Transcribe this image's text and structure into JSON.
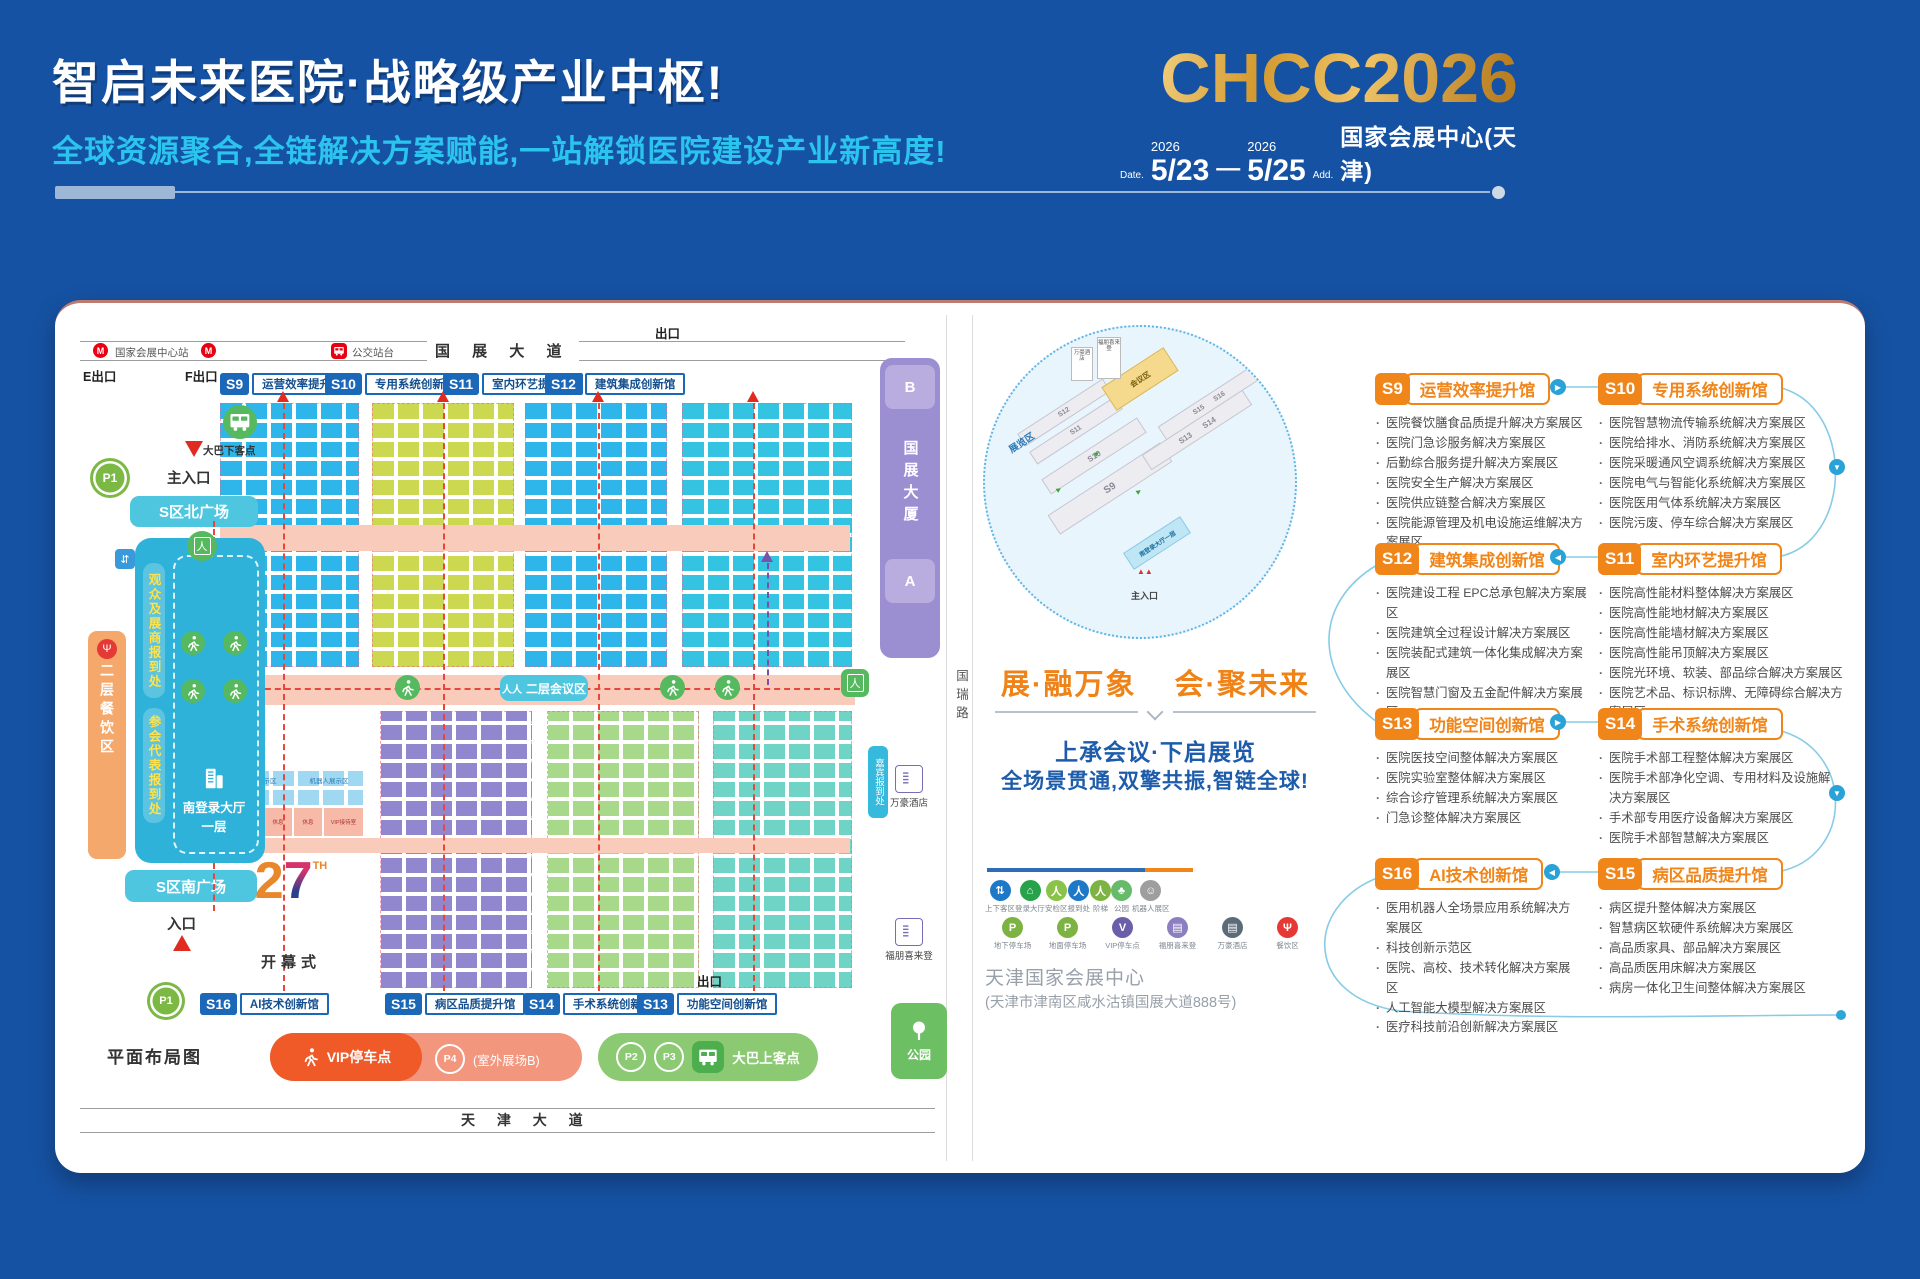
{
  "header": {
    "title": "智启未来医院·战略级产业中枢!",
    "subtitle": "全球资源聚合,全链解决方案赋能,一站解锁医院建设产业新高度!",
    "logo": "CHCC2026",
    "date_label": "Date.",
    "year_start": "2026",
    "date_start": "5/23",
    "date_dash": "—",
    "year_end": "2026",
    "date_end": "5/25",
    "addr_label": "Add.",
    "venue": "国家会展中心(天津)"
  },
  "map": {
    "caption": "平面布局图",
    "roads": {
      "top": "国 展 大 道",
      "bottom": "天 津 大 道",
      "right": "国瑞路"
    },
    "transit": {
      "station": "国家会展中心站",
      "bus_stop": "公交站台",
      "exit_e": "E出口",
      "exit_f": "F出口",
      "exit_top": "出口",
      "exit_bottom": "出口"
    },
    "halls_top": [
      {
        "id": "S9",
        "name": "运营效率提升馆"
      },
      {
        "id": "S10",
        "name": "专用系统创新馆"
      },
      {
        "id": "S11",
        "name": "室内环艺提升馆"
      },
      {
        "id": "S12",
        "name": "建筑集成创新馆"
      }
    ],
    "halls_bottom": [
      {
        "id": "S16",
        "name": "AI技术创新馆"
      },
      {
        "id": "S15",
        "name": "病区品质提升馆"
      },
      {
        "id": "S14",
        "name": "手术系统创新馆"
      },
      {
        "id": "S13",
        "name": "功能空间创新馆"
      }
    ],
    "west": {
      "main_entrance": "主入口",
      "bus_drop": "大巴下客点",
      "p1": "P1",
      "north_plaza": "S区北广场",
      "visitor_reg": "观众及展商报到处",
      "delegate_reg": "参会代表报到处",
      "dining": "二层餐饮区",
      "south_hall": "南登录大厅",
      "floor1": "一层",
      "south_plaza": "S区南广场",
      "entrance": "入口"
    },
    "center": {
      "meeting": "二层会议区",
      "ceremony": "开幕式",
      "logo_num2": "2",
      "logo_num7": "7",
      "logo_th": "TH",
      "robot_zone": "机器人展示区",
      "vip_room": "VIP接待室",
      "rest": "休息"
    },
    "east": {
      "b": "B",
      "tower": "国展大厦",
      "a": "A",
      "guest_reg": "嘉宾报到处",
      "hotel_marriott": "万豪酒店",
      "hotel_fourpoints": "福朋喜来登",
      "park": "公园"
    },
    "south": {
      "vip_parking": "VIP停车点",
      "p4": "P4",
      "outdoor": "(室外展场B)",
      "p2": "P2",
      "p3": "P3",
      "bus_pickup": "大巴上客点"
    }
  },
  "mini_map": {
    "zone_exhibition": "展览区",
    "zone_conference": "会议区",
    "s9": "S9",
    "s10": "S10",
    "s11": "S11",
    "s12": "S12",
    "s13": "S13",
    "s14": "S14",
    "s15": "S15",
    "s16": "S16",
    "south_hall": "南登录大厅一层",
    "main_entrance": "主入口",
    "hotel_marriott": "万豪酒店",
    "hotel_fourpoints": "福朋喜来登"
  },
  "slogan": {
    "left": "展·融万象",
    "right": "会·聚未来",
    "line1": "上承会议·下启展览",
    "line2": "全场景贯通,双擎共振,智链全球!"
  },
  "legend": {
    "row1": [
      {
        "label": "上下客区",
        "glyph": "⇅",
        "color": "#1e78c8"
      },
      {
        "label": "登录大厅",
        "glyph": "⌂",
        "color": "#27a24b"
      },
      {
        "label": "安检区",
        "glyph": "人",
        "color": "#8bc34a"
      },
      {
        "label": "报到处",
        "glyph": "人",
        "color": "#1e78c8"
      },
      {
        "label": "阶梯",
        "glyph": "人",
        "color": "#7cb342"
      },
      {
        "label": "公园",
        "glyph": "♣",
        "color": "#66bb6a"
      },
      {
        "label": "机器人展区",
        "glyph": "☺",
        "color": "#9e9e9e"
      }
    ],
    "row2": [
      {
        "label": "地下停车场",
        "glyph": "P",
        "color": "#7cb342"
      },
      {
        "label": "地面停车场",
        "glyph": "P",
        "color": "#7cb342"
      },
      {
        "label": "VIP停车点",
        "glyph": "V",
        "color": "#6a5fa8"
      },
      {
        "label": "福朋喜来登",
        "glyph": "▤",
        "color": "#8c7fc0"
      },
      {
        "label": "万豪酒店",
        "glyph": "▤",
        "color": "#5c6b7a"
      },
      {
        "label": "餐饮区",
        "glyph": "Ψ",
        "color": "#e53935"
      }
    ]
  },
  "address": {
    "name": "天津国家会展中心",
    "detail": "(天津市津南区咸水沽镇国展大道888号)"
  },
  "sections": [
    {
      "id": "S9",
      "name": "运营效率提升馆",
      "items": [
        "医院餐饮膳食品质提升解决方案展区",
        "医院门急诊服务解决方案展区",
        "后勤综合服务提升解决方案展区",
        "医院安全生产解决方案展区",
        "医院供应链整合解决方案展区",
        "医院能源管理及机电设施运维解决方案展区"
      ]
    },
    {
      "id": "S10",
      "name": "专用系统创新馆",
      "items": [
        "医院智慧物流传输系统解决方案展区",
        "医院给排水、消防系统解决方案展区",
        "医院采暖通风空调系统解决方案展区",
        "医院电气与智能化系统解决方案展区",
        "医院医用气体系统解决方案展区",
        "医院污废、停车综合解决方案展区"
      ]
    },
    {
      "id": "S12",
      "name": "建筑集成创新馆",
      "items": [
        "医院建设工程 EPC总承包解决方案展区",
        "医院建筑全过程设计解决方案展区",
        "医院装配式建筑一体化集成解决方案展区",
        "医院智慧门窗及五金配件解决方案展区"
      ]
    },
    {
      "id": "S11",
      "name": "室内环艺提升馆",
      "items": [
        "医院高性能材料整体解决方案展区",
        "医院高性能地材解决方案展区",
        "医院高性能墙材解决方案展区",
        "医院高性能吊顶解决方案展区",
        "医院光环境、软装、部品综合解决方案展区",
        "医院艺术品、标识标牌、无障碍综合解决方案展区"
      ]
    },
    {
      "id": "S13",
      "name": "功能空间创新馆",
      "items": [
        "医院医技空间整体解决方案展区",
        "医院实验室整体解决方案展区",
        "综合诊疗管理系统解决方案展区",
        "门急诊整体解决方案展区"
      ]
    },
    {
      "id": "S14",
      "name": "手术系统创新馆",
      "items": [
        "医院手术部工程整体解决方案展区",
        "医院手术部净化空调、专用材料及设施解决方案展区",
        "手术部专用医疗设备解决方案展区",
        "医院手术部智慧解决方案展区"
      ]
    },
    {
      "id": "S16",
      "name": "AI技术创新馆",
      "items": [
        "医用机器人全场景应用系统解决方案展区",
        "科技创新示范区",
        "医院、高校、技术转化解决方案展区",
        "人工智能大模型解决方案展区",
        "医疗科技前沿创新解决方案展区"
      ]
    },
    {
      "id": "S15",
      "name": "病区品质提升馆",
      "items": [
        "病区提升整体解决方案展区",
        "智慧病区软硬件系统解决方案展区",
        "高品质家具、部品解决方案展区",
        "高品质医用床解决方案展区",
        "病房一体化卫生间整体解决方案展区"
      ]
    }
  ],
  "colors": {
    "page_bg": "#1652a3",
    "accent_orange": "#f08519",
    "accent_blue": "#1b67b8",
    "gold": "#d9a63f",
    "cyan": "#2ac4ee"
  }
}
